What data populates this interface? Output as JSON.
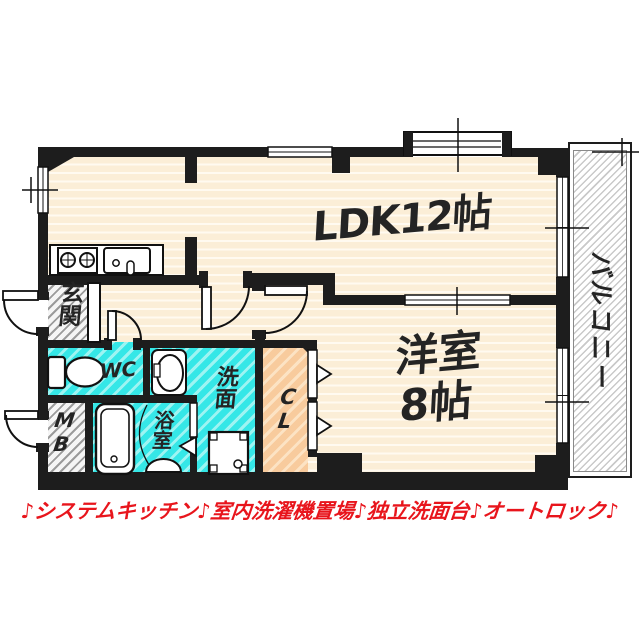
{
  "floor_plan": {
    "rooms": {
      "ldk": {
        "label": "LDK12帖"
      },
      "western_room": {
        "name": "洋室",
        "size": "8帖"
      },
      "balcony": {
        "label": "バルコニー"
      },
      "entrance": {
        "label": "玄関"
      },
      "toilet": {
        "label": "WC"
      },
      "washroom": {
        "label": "洗面"
      },
      "bathroom": {
        "label": "浴室"
      },
      "closet": {
        "label": "CL"
      },
      "meter_box": {
        "label": "MB"
      }
    },
    "banner": {
      "text": "♪システムキッチン♪室内洗濯機置場♪独立洗面台♪オートロック♪"
    },
    "colors": {
      "wall": "#1d1d1d",
      "flooring": "#fbeed7",
      "wet_area": "#35e7e7",
      "closet_fill": "#f8cb9d",
      "service_hatch": "#9b9b9b",
      "banner_text": "#e8151c"
    }
  }
}
